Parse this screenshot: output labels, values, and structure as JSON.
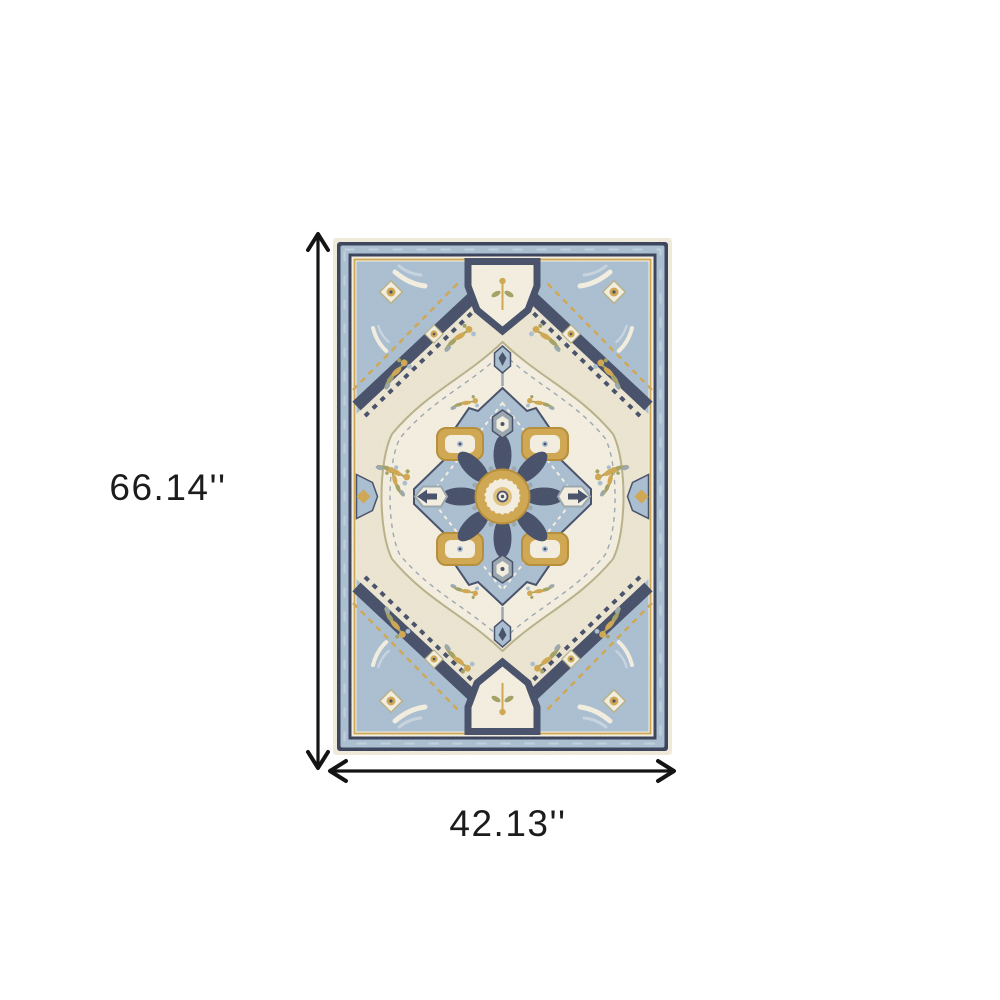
{
  "labels": {
    "height": "66.14''",
    "width": "42.13''"
  },
  "rug": {
    "alt": "Blue ivory and gold oriental medallion area rug"
  },
  "colors": {
    "bg": "#ffffff",
    "dim": "#141414",
    "text": "#1c1c1c",
    "fringe": "#f3eedd",
    "cream": "#efe8d4",
    "cream-light": "#f7f2e3",
    "navy": "#424c67",
    "navy-dark": "#353e58",
    "blue": "#aac0d4",
    "blue-light": "#c9d7e3",
    "gold": "#d2a84e",
    "gold-dark": "#b68d35",
    "gold-light": "#e4c57d",
    "olive": "#a3a161",
    "grey": "#9aa7b0",
    "tan": "#b9b289"
  }
}
